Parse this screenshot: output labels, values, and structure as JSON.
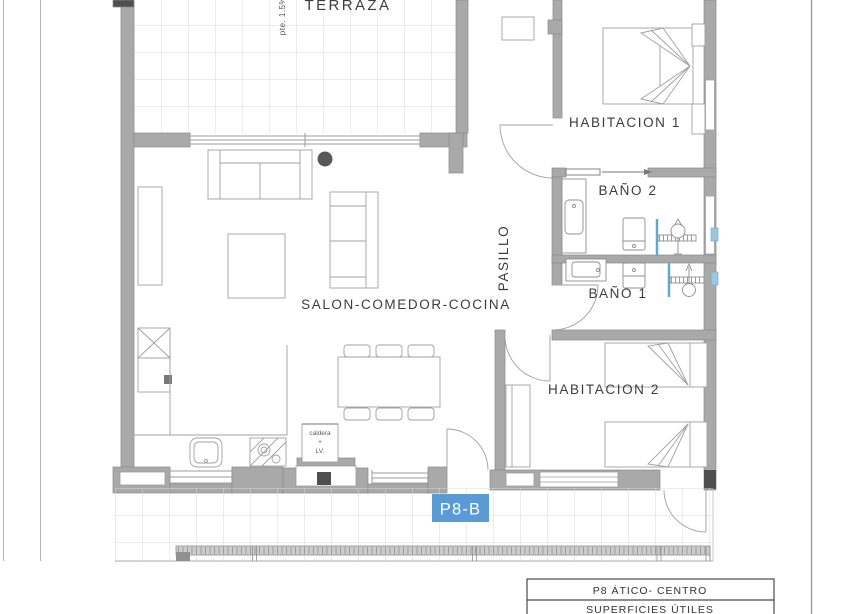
{
  "floor_plan": {
    "rooms": [
      {
        "id": "terraza",
        "label": "TERRAZA"
      },
      {
        "id": "habitacion1",
        "label": "HABITACION 1"
      },
      {
        "id": "bano2",
        "label": "BAÑO 2"
      },
      {
        "id": "bano1",
        "label": "BAÑO 1"
      },
      {
        "id": "pasillo",
        "label": "PASILLO"
      },
      {
        "id": "salon",
        "label": "SALON-COMEDOR-COCINA"
      },
      {
        "id": "habitacion2",
        "label": "HABITACION 2"
      }
    ],
    "annotations": {
      "terrace_slope": "pte. 1.5%",
      "kitchen_unit": {
        "line1": "caldera",
        "line2": "+",
        "line3": "LV."
      }
    },
    "unit_tag": {
      "label": "P8-B",
      "bg": "#5b9bd5",
      "text_color": "#ffffff"
    },
    "colors": {
      "wall_fill": "#a9a9a9",
      "wall_edge": "#8a8a8a",
      "wall_dark": "#4f4f4f",
      "tile_line": "#d8d8d8",
      "furniture_line": "#a0a0a0",
      "glass_blue": "#64a8cc",
      "text": "#3c3c3c"
    }
  },
  "title_block": {
    "row1": "P8 ÁTICO- CENTRO",
    "row2": "SUPERFICIES ÚTILES"
  }
}
